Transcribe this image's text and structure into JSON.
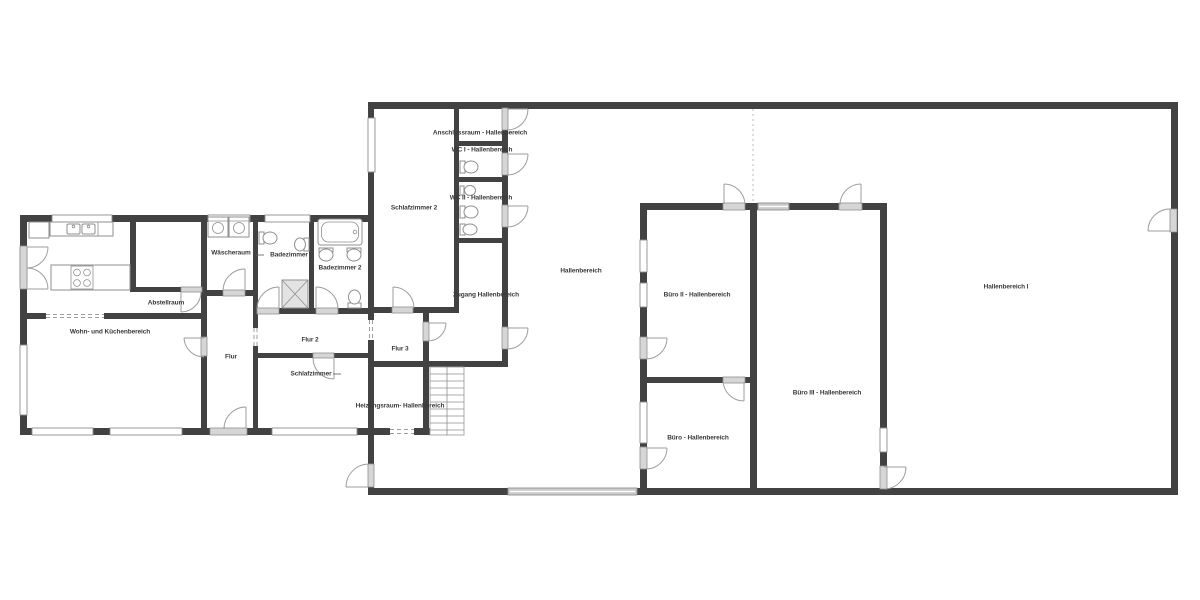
{
  "palette": {
    "wall": "#424242",
    "door": "#d6d6d6",
    "door_border": "#8f8f8f",
    "window_fill": "#ffffff",
    "arc": "#9e9e9e",
    "label": "#3a3a3a"
  },
  "icons": {
    "bathtub": "svg-shape",
    "toilet": "svg-shape",
    "sink": "svg-shape",
    "shower": "svg-shape",
    "stove": "svg-shape",
    "washing_machine": "svg-shape",
    "stairs": "svg-shape",
    "door_swing": "svg-arc",
    "window": "svg-rect"
  },
  "rooms": {
    "wohn_kueche": {
      "label": "Wohn- und Küchenbereich"
    },
    "abstellraum": {
      "label": "Abstellraum"
    },
    "waescheraum": {
      "label": "Wäscheraum"
    },
    "badezimmer": {
      "label": "Badezimmer"
    },
    "badezimmer2": {
      "label": "Badezimmer 2"
    },
    "flur": {
      "label": "Flur"
    },
    "flur2": {
      "label": "Flur 2"
    },
    "flur3": {
      "label": "Flur 3"
    },
    "schlafzimmer": {
      "label": "Schlafzimmer"
    },
    "schlafzimmer2": {
      "label": "Schlafzimmer 2"
    },
    "heizungsraum": {
      "label": "Heizungsraum- Hallenbereich"
    },
    "zugang": {
      "label": "Zugang Hallenbereich"
    },
    "anschlussraum": {
      "label": "Anschlussraum - Hallenbereich"
    },
    "wc1": {
      "label": "WC I - Hallenbereich"
    },
    "wc2": {
      "label": "WC II - Hallenbereich"
    },
    "hallenbereich": {
      "label": "Hallenbereich"
    },
    "hallenbereich1": {
      "label": "Hallenbereich I"
    },
    "buero": {
      "label": "Büro - Hallenbereich"
    },
    "buero2": {
      "label": "Büro II - Hallenbereich"
    },
    "buero3": {
      "label": "Büro III - Hallenbereich"
    }
  }
}
